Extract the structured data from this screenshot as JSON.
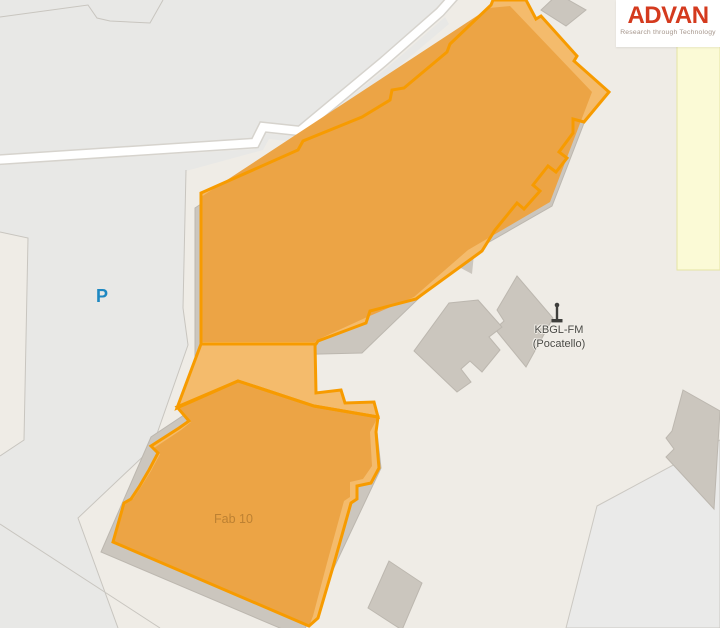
{
  "map": {
    "parking_label": "P",
    "highlighted_building_label": "Fab 10",
    "poi": {
      "name_line1": "KBGL-FM",
      "name_line2": "(Pocatello)",
      "icon": "antenna-mast-icon"
    },
    "colors": {
      "ground": "#EFECE6",
      "parcel_gray": "#E8E8E6",
      "parcel_gray_right": "#EAEAE9",
      "building_gray": "#CBC6BE",
      "building_gray_stroke": "#BCB7AF",
      "landuse_yellow": "#FBFAD6",
      "landuse_yellow_border": "#E6E4A4",
      "highlight_fill_light": "#F4BB6C",
      "highlight_fill_dark": "#ECA445",
      "highlight_stroke": "#F79B00",
      "parking_blue": "#1E88C2",
      "poi_text": "#4B4B47",
      "fab_label_color": "#BD8132",
      "road_white": "#FFFFFF",
      "boundary_line": "#C8C5BF"
    }
  },
  "logo": {
    "name": "ADVAN",
    "tagline": "Research through Technology",
    "accent_color": "#D43A1E"
  }
}
